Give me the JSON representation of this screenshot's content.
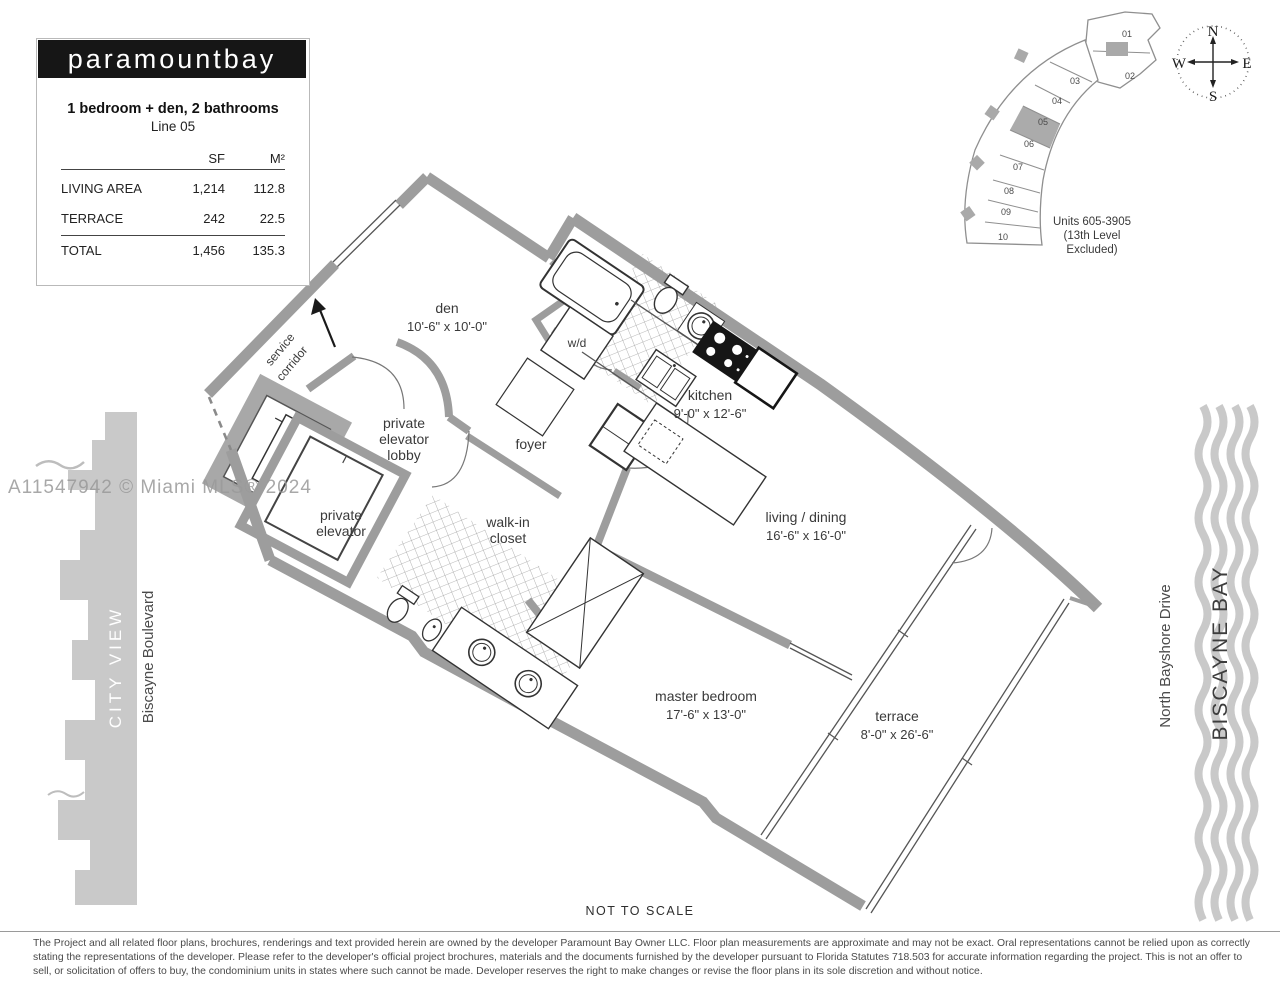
{
  "panel": {
    "logo": "paramountbay",
    "title": "1 bedroom + den, 2 bathrooms",
    "subtitle": "Line 05",
    "table": {
      "col_sf": "SF",
      "col_m2": "M²",
      "rows": [
        {
          "label": "LIVING AREA",
          "sf": "1,214",
          "m2": "112.8"
        },
        {
          "label": "TERRACE",
          "sf": "242",
          "m2": "22.5"
        },
        {
          "label": "TOTAL",
          "sf": "1,456",
          "m2": "135.3"
        }
      ]
    }
  },
  "keyplan": {
    "units": [
      "01",
      "02",
      "03",
      "04",
      "05",
      "06",
      "07",
      "08",
      "09",
      "10"
    ],
    "highlighted_unit": "05",
    "caption": [
      "Units 605-3905",
      "(13th Level",
      "Excluded)"
    ],
    "compass": {
      "n": "N",
      "e": "E",
      "s": "S",
      "w": "W"
    }
  },
  "plan": {
    "rooms": {
      "den": {
        "name": "den",
        "dims": "10'-6\" x 10'-0\""
      },
      "kitchen": {
        "name": "kitchen",
        "dims": "9'-0\" x 12'-6\""
      },
      "living": {
        "name": "living / dining",
        "dims": "16'-6\" x 16'-0\""
      },
      "master": {
        "name": "master bedroom",
        "dims": "17'-6\" x 13'-0\""
      },
      "terrace": {
        "name": "terrace",
        "dims": "8'-0\" x 26'-6\""
      },
      "foyer": "foyer",
      "lobby": [
        "private",
        "elevator",
        "lobby"
      ],
      "elevator": [
        "private",
        "elevator"
      ],
      "closet": [
        "walk-in",
        "closet"
      ],
      "wd": "w/d",
      "service": [
        "service",
        "corridor"
      ]
    },
    "not_to_scale": "NOT TO SCALE"
  },
  "context": {
    "watermark": "A11547942 © Miami MLS® 2024",
    "city_view": "CITY VIEW",
    "biscayne_boulevard": "Biscayne Boulevard",
    "north_bayshore_drive": "North Bayshore Drive",
    "biscayne_bay": "BISCAYNE BAY"
  },
  "footer": {
    "disclaimer": "The Project and all related floor plans, brochures, renderings and text provided herein are owned by the developer Paramount Bay Owner LLC.  Floor plan measurements are approximate and may not be exact. Oral representations cannot be relied upon as correctly stating the representations of the developer.  Please refer to the developer's official project brochures, materials and the documents furnished by the developer pursuant to Florida Statutes 718.503 for accurate information regarding the project.  This is not an offer to sell, or solicitation of offers to buy, the condominium units in states where such cannot be made.  Developer reserves the right to make changes or revise the floor plans in its sole discretion and without notice."
  },
  "colors": {
    "wall_gray": "#9d9d9d",
    "silhouette_gray": "#c9c9c9",
    "label_gray": "#3a3a3a",
    "logo_bg": "#161616",
    "highlight_unit": "#ababab"
  }
}
